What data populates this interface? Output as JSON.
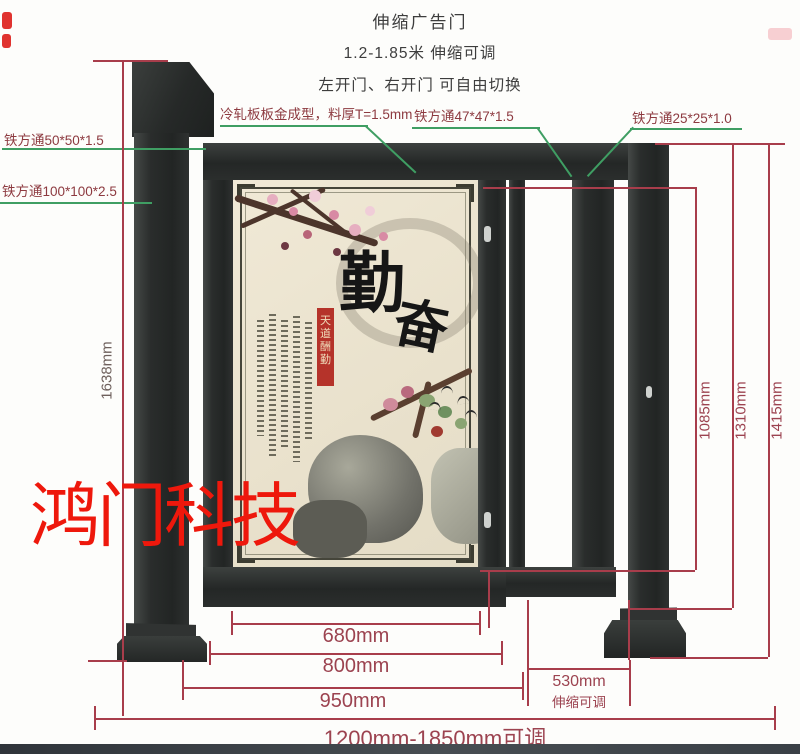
{
  "header": {
    "line1": "伸缩广告门",
    "line2": "1.2-1.85米 伸缩可调",
    "line3": "左开门、右开门 可自由切换"
  },
  "callouts": {
    "tube_50": "铁方通50*50*1.5",
    "tube_100": "铁方通100*100*2.5",
    "sheet_metal": "冷轧板板金成型，料厚T=1.5mm",
    "tube_47": "铁方通47*47*1.5",
    "tube_25": "铁方通25*25*1.0"
  },
  "dimensions": {
    "left_total_height": "1638mm",
    "opening_height": "1085mm",
    "frame_height": "1310mm",
    "overall_height": "1415mm",
    "poster_width": "680mm",
    "door_width": "800mm",
    "door_outer_width": "950mm",
    "telescopic_width": "530mm",
    "telescopic_note": "伸缩可调",
    "overall_width_range": "1200mm-1850mm可调"
  },
  "poster": {
    "calligraphy_char_1": "勤",
    "calligraphy_char_2": "奋",
    "seal_ribbon_text": "天道酬勤"
  },
  "watermark": "鸿门科技",
  "colors": {
    "gate_dark": "#2a2d2c",
    "dimension_red": "#a83d4b",
    "leader_green": "#3f9e63",
    "callout_maroon": "#8d3a40",
    "watermark_red": "#ee180c",
    "poster_cream": "#ece4d0"
  }
}
